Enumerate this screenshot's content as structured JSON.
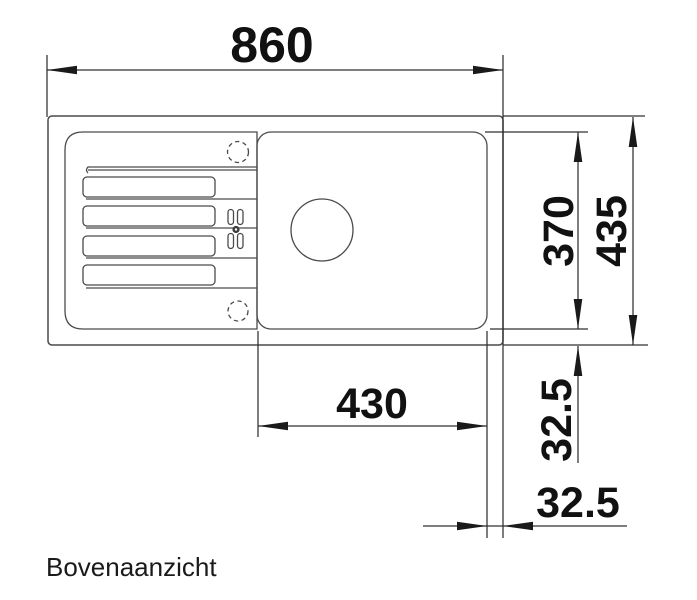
{
  "caption": "Bovenaanzicht",
  "dimensions": {
    "total_width": "860",
    "bowl_cutout_width": "430",
    "basin_depth": "370",
    "total_depth": "435",
    "rim_offset_vertical": "32.5",
    "rim_offset_horizontal": "32.5"
  },
  "colors": {
    "background": "#ffffff",
    "drawing_line": "#4a4a4a",
    "dimension_line": "#303030",
    "text": "#111111"
  }
}
